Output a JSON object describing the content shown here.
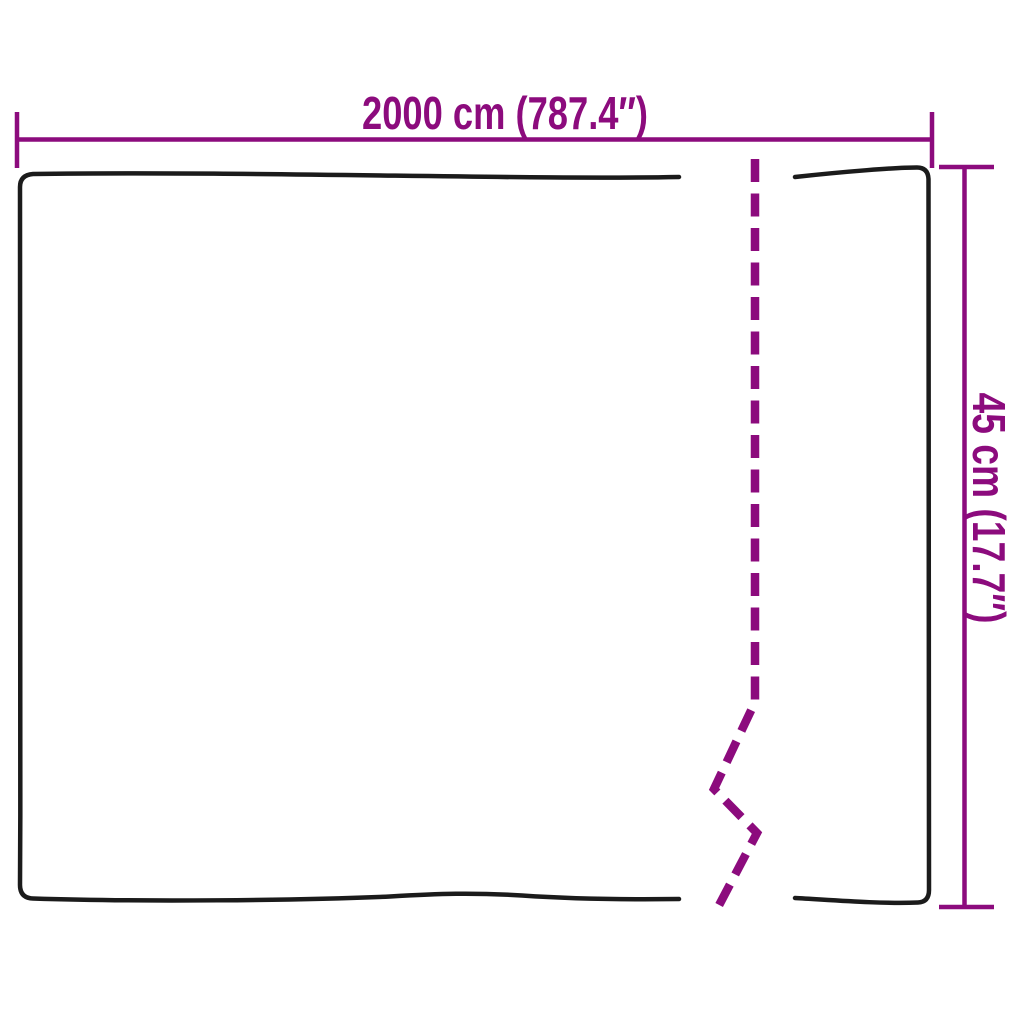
{
  "diagram": {
    "width_dimension": {
      "label": "2000 cm (787.4″)"
    },
    "height_dimension": {
      "label": "45 cm (17.7″)"
    }
  },
  "colors": {
    "dimension": "#8C0B7D",
    "outline": "#1B1B1B",
    "background": "#FFFFFF"
  }
}
